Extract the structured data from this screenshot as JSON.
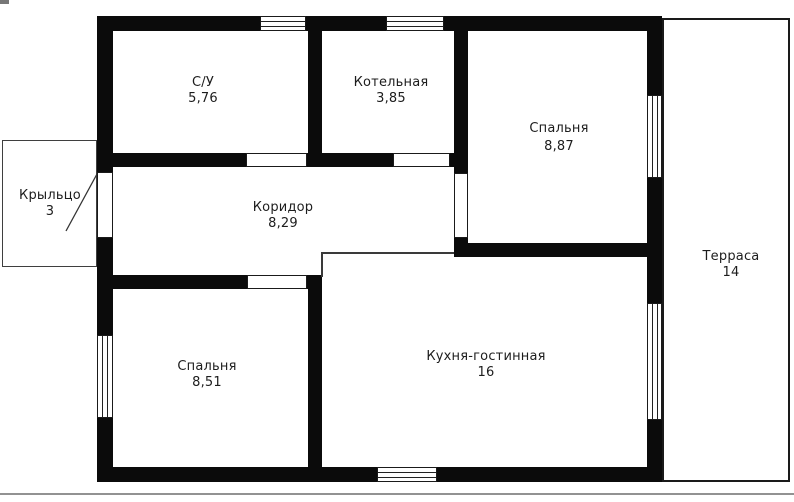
{
  "plan_title": "floor-plan",
  "rooms": [
    {
      "id": "bathroom",
      "name": "С/У",
      "area": "5,76"
    },
    {
      "id": "boiler-room",
      "name": "Котельная",
      "area": "3,85"
    },
    {
      "id": "bedroom-right",
      "name": "Спальня",
      "area": "8,87"
    },
    {
      "id": "corridor",
      "name": "Коридор",
      "area": "8,29"
    },
    {
      "id": "bedroom-left",
      "name": "Спальня",
      "area": "8,51"
    },
    {
      "id": "kitchen-living",
      "name": "Кухня-гостинная",
      "area": "16"
    },
    {
      "id": "porch",
      "name": "Крыльцо",
      "area": "3"
    },
    {
      "id": "terrace",
      "name": "Терраса",
      "area": "14"
    }
  ],
  "colors": {
    "wall": "#0b0b0b",
    "background": "#ffffff",
    "outline": "#1a1a1a",
    "text": "#1d1d1d",
    "page_divider": "#929292"
  }
}
